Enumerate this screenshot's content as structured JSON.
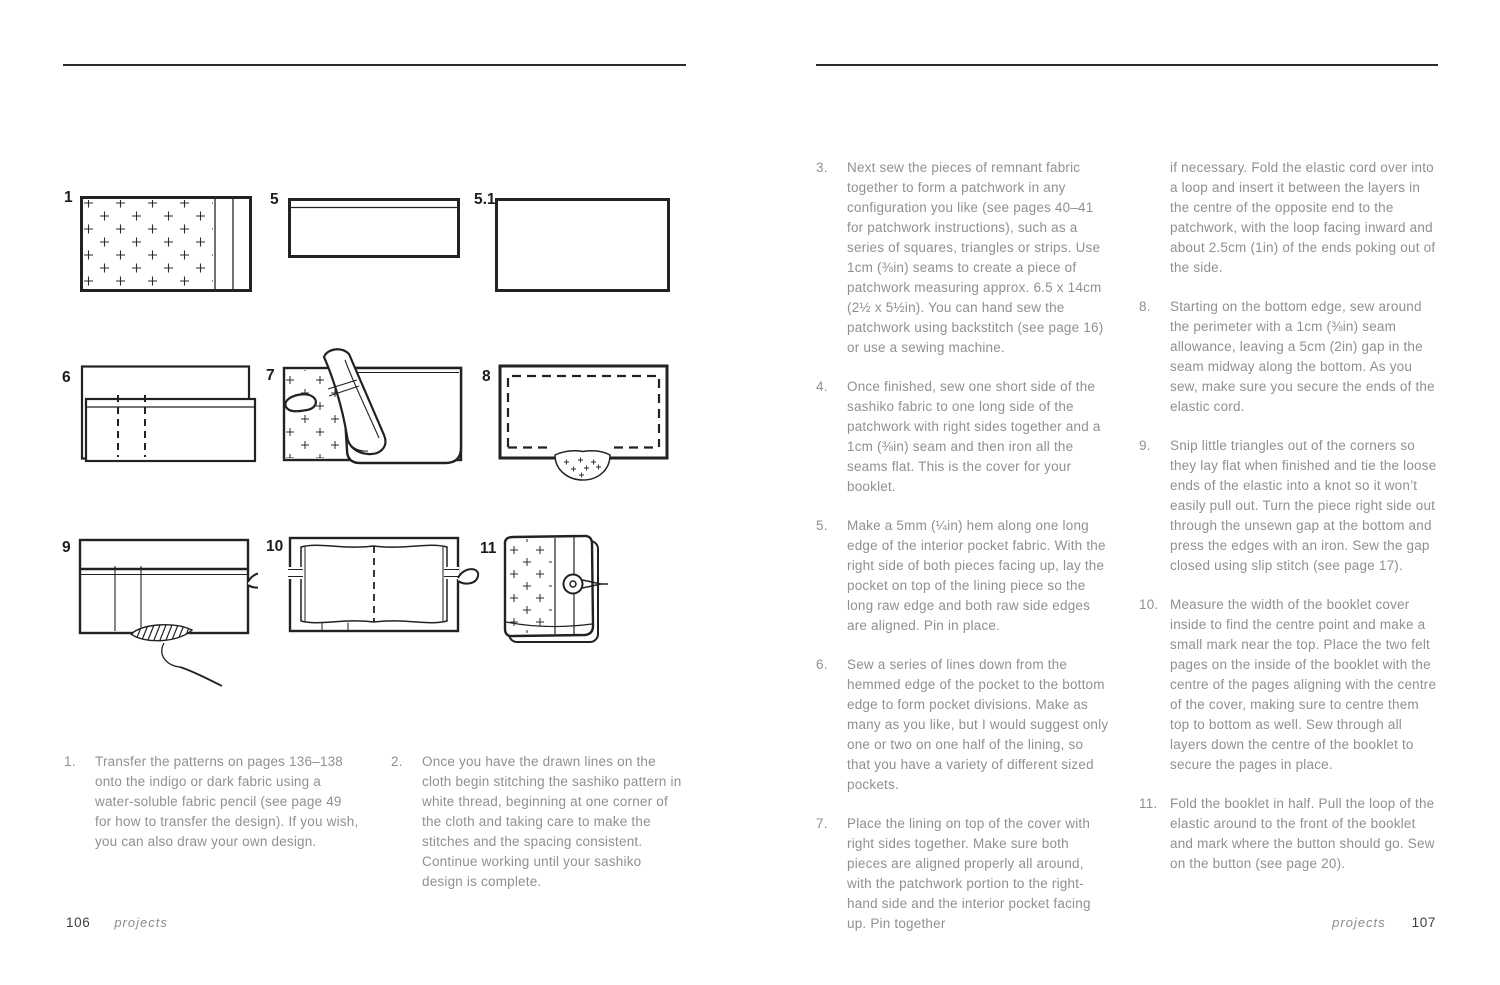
{
  "page_left": {
    "figures": [
      {
        "label": "1"
      },
      {
        "label": "5"
      },
      {
        "label": "5.1"
      },
      {
        "label": "6"
      },
      {
        "label": "7"
      },
      {
        "label": "8"
      },
      {
        "label": "9"
      },
      {
        "label": "10"
      },
      {
        "label": "11"
      }
    ],
    "steps": [
      {
        "num": "1.",
        "text": "Transfer the patterns on pages 136–138 onto the indigo or dark fabric using a water-soluble fabric pencil (see page 49 for how to transfer the design). If you wish, you can also draw your own design."
      },
      {
        "num": "2.",
        "text": "Once you have the drawn lines on the cloth begin stitching the sashiko pattern in white thread, beginning at one corner of the cloth and taking care to make the stitches and the spacing consistent. Continue working until your sashiko design is complete."
      }
    ],
    "footer": {
      "page_number": "106",
      "section": "projects"
    }
  },
  "page_right": {
    "column_left": [
      {
        "num": "3.",
        "text": "Next sew the pieces of remnant fabric together to form a patchwork in any configuration you like (see pages 40–41 for patchwork instructions), such as a series of squares, triangles or strips. Use 1cm (⅜in) seams to create a piece of patchwork measuring approx. 6.5 x 14cm (2½ x 5½in). You can hand sew the patchwork using backstitch (see page 16) or use a sewing machine."
      },
      {
        "num": "4.",
        "text": "Once finished, sew one short side of the sashiko fabric to one long side of the patchwork with right sides together and a 1cm (⅜in) seam and then iron all the seams flat. This is the cover for your booklet."
      },
      {
        "num": "5.",
        "text": "Make a 5mm (¼in) hem along one long edge of the interior pocket fabric. With the right side of both pieces facing up, lay the pocket on top of the lining piece so the long raw edge and both raw side edges are aligned. Pin in place."
      },
      {
        "num": "6.",
        "text": "Sew a series of lines down from the hemmed edge of the pocket to the bottom edge to form pocket divisions. Make as many as you like, but I would suggest only one or two on one half of the lining, so that you have a variety of different sized pockets."
      },
      {
        "num": "7.",
        "text": "Place the lining on top of the cover with right sides together. Make sure both pieces are aligned properly all around, with the patchwork portion to the right-hand side and the interior pocket facing up. Pin together"
      }
    ],
    "column_right": [
      {
        "num": "",
        "text": "if necessary. Fold the elastic cord over into a loop and insert it between the layers in the centre of the opposite end to the patchwork, with the loop facing inward and about 2.5cm (1in) of the ends poking out of the side."
      },
      {
        "num": "8.",
        "text": "Starting on the bottom edge, sew around the perimeter with a 1cm (⅜in) seam allowance, leaving a 5cm (2in) gap in the seam midway along the bottom. As you sew, make sure you secure the ends of the elastic cord."
      },
      {
        "num": "9.",
        "text": "Snip little triangles out of the corners so they lay flat when finished and tie the loose ends of the elastic into a knot so it won’t easily pull out. Turn the piece right side out through the unsewn gap at the bottom and press the edges with an iron. Sew the gap closed using slip stitch (see page 17)."
      },
      {
        "num": "10.",
        "text": "Measure the width of the booklet cover inside to find the centre point and make a small mark near the top. Place the two felt pages on the inside of the booklet with the centre of the pages aligning with the centre of the cover, making sure to centre them top to bottom as well. Sew through all layers down the centre of the booklet to secure the pages in place."
      },
      {
        "num": "11.",
        "text": "Fold the booklet in half. Pull the loop of the elastic around to the front of the booklet and mark where the button should go. Sew on the button (see page 20)."
      }
    ],
    "footer": {
      "page_number": "107",
      "section": "projects"
    }
  }
}
